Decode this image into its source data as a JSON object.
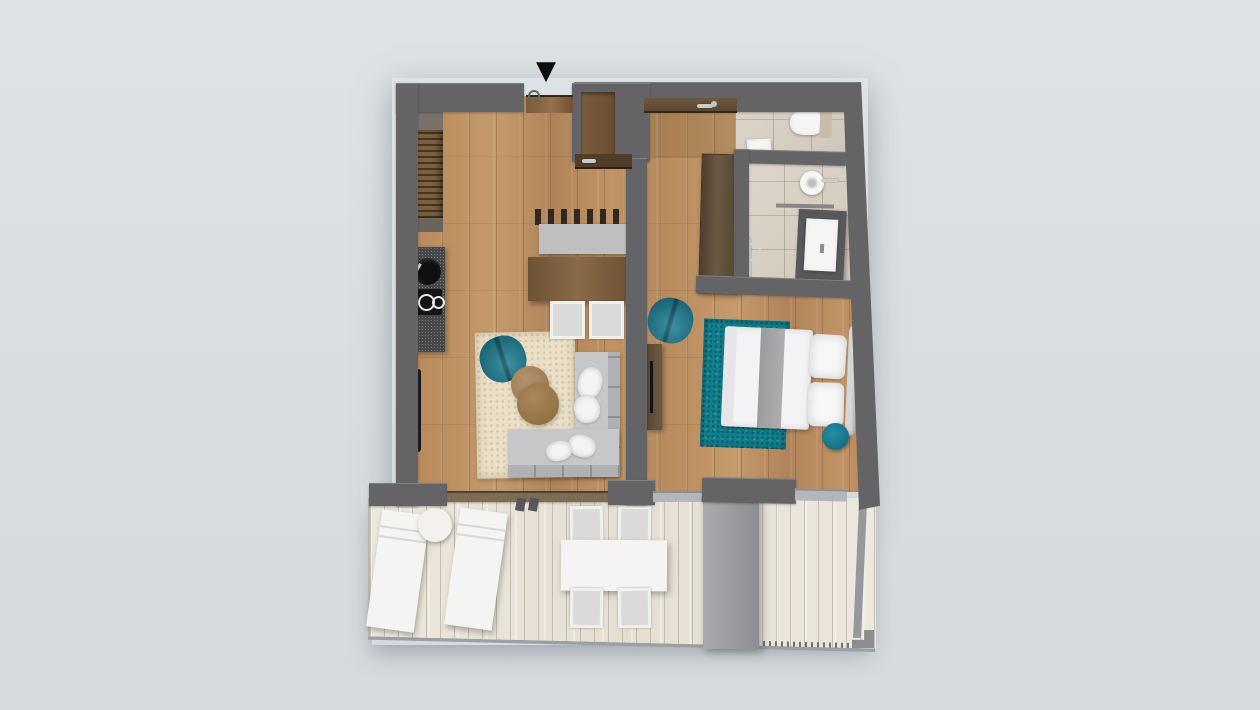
{
  "scene": {
    "kind": "apartment-floor-plan-render",
    "view": "top-down",
    "marker": {
      "glyph": "▼",
      "meaning": "entrance-indicator"
    }
  },
  "palette": {
    "background": "#d8dee1",
    "wall": "#646467",
    "wood_floor": "#bb8e60",
    "bathroom_tile": "#d7d0c4",
    "balcony_deck": "#eae5da",
    "teal_accent": "#1d7f96",
    "teal_rug": "#10808e",
    "beige_rug": "#eadfc7",
    "sofa_gray": "#c5c7c9",
    "furniture_white": "#f5f5f4",
    "cabinet_brown": "#5f4f3e",
    "counter_dark": "#474749"
  },
  "rooms": [
    {
      "id": "living-kitchen",
      "floor": "wood"
    },
    {
      "id": "bedroom",
      "floor": "wood"
    },
    {
      "id": "wc",
      "floor": "tile"
    },
    {
      "id": "shower-room",
      "floor": "tile"
    },
    {
      "id": "balcony",
      "floor": "whitewashed-deck"
    }
  ],
  "furniture": [
    "entrance-door",
    "hall-wardrobe",
    "kitchen-counter",
    "kitchen-sink",
    "kitchen-cooktop",
    "tall-cabinet-handle",
    "dining-bench",
    "dining-table",
    "dining-chair",
    "dining-chair",
    "beige-rug",
    "teal-armchair-living",
    "pouf",
    "pouf",
    "corner-sofa",
    "sofa-pillows",
    "sideboard",
    "teal-armchair-bedroom",
    "teal-bedroom-rug",
    "double-bed",
    "bed-pillows",
    "teal-stool",
    "bedroom-wardrobe",
    "toilet",
    "wc-mat",
    "round-basin",
    "vanity-sink",
    "towel-bar",
    "sun-lounger",
    "sun-lounger",
    "round-side-table",
    "balcony-table",
    "balcony-chair",
    "balcony-chair",
    "balcony-chair",
    "balcony-chair",
    "awning-panel",
    "balcony-rail"
  ]
}
